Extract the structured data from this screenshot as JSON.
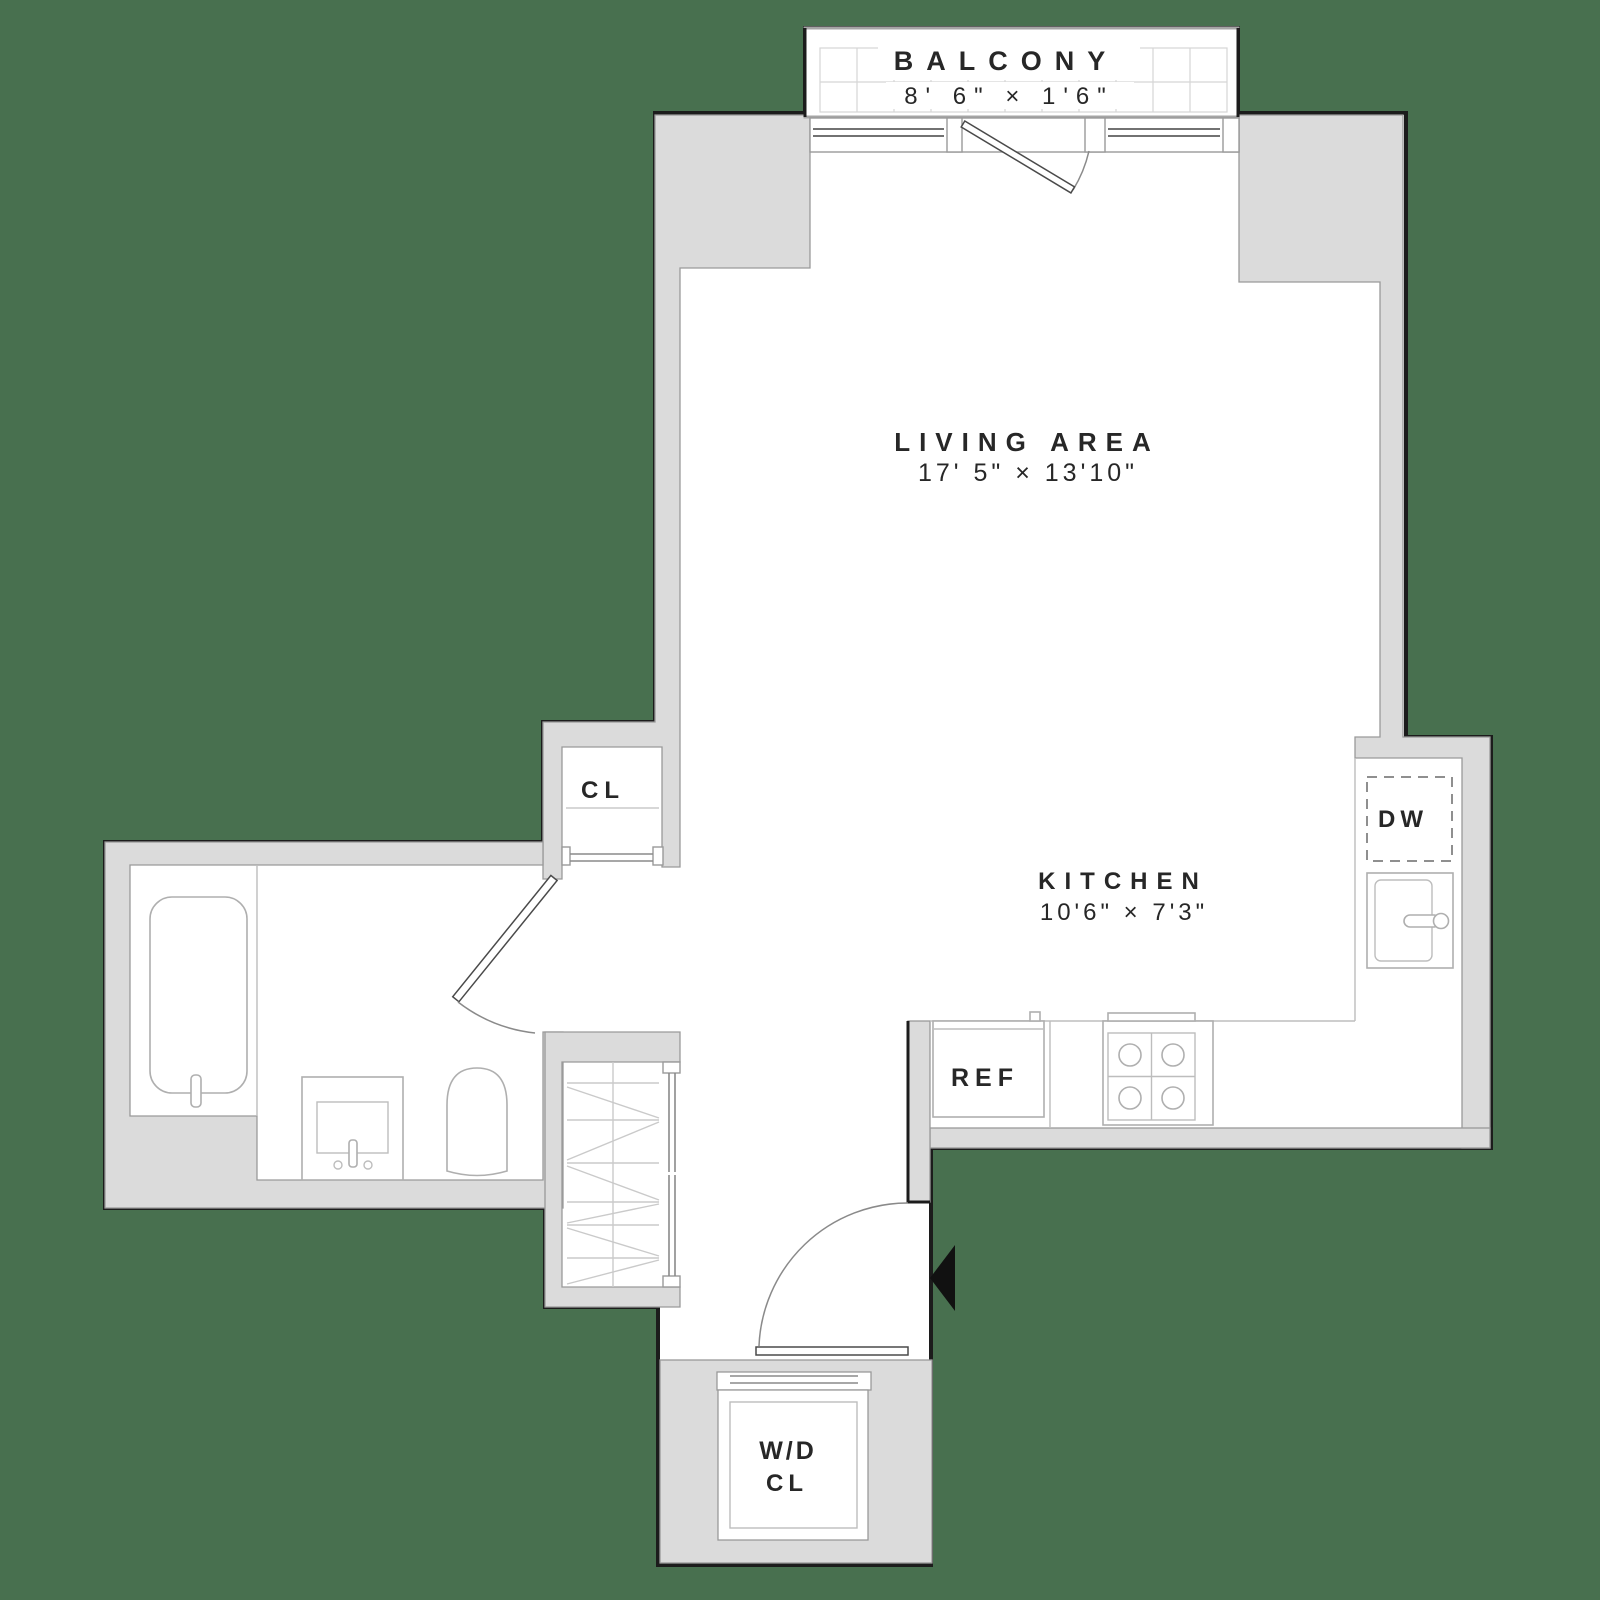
{
  "colors": {
    "background": "#48704F",
    "wall": "#DBDBDB",
    "floor": "#FFFFFF",
    "outline": "#1C1C1C",
    "text": "#272727"
  },
  "rooms": {
    "balcony": {
      "label": "BALCONY",
      "dims": "8' 6\" × 1'6\""
    },
    "living_area": {
      "label": "LIVING AREA",
      "dims": "17' 5\" × 13'10\""
    },
    "kitchen": {
      "label": "KITCHEN",
      "dims": "10'6\" × 7'3\""
    },
    "closet": {
      "label": "CL"
    },
    "washer_dryer_closet": {
      "line1": "W/D",
      "line2": "CL"
    }
  },
  "appliances": {
    "dishwasher": {
      "label": "DW"
    },
    "refrigerator": {
      "label": "REF"
    }
  }
}
